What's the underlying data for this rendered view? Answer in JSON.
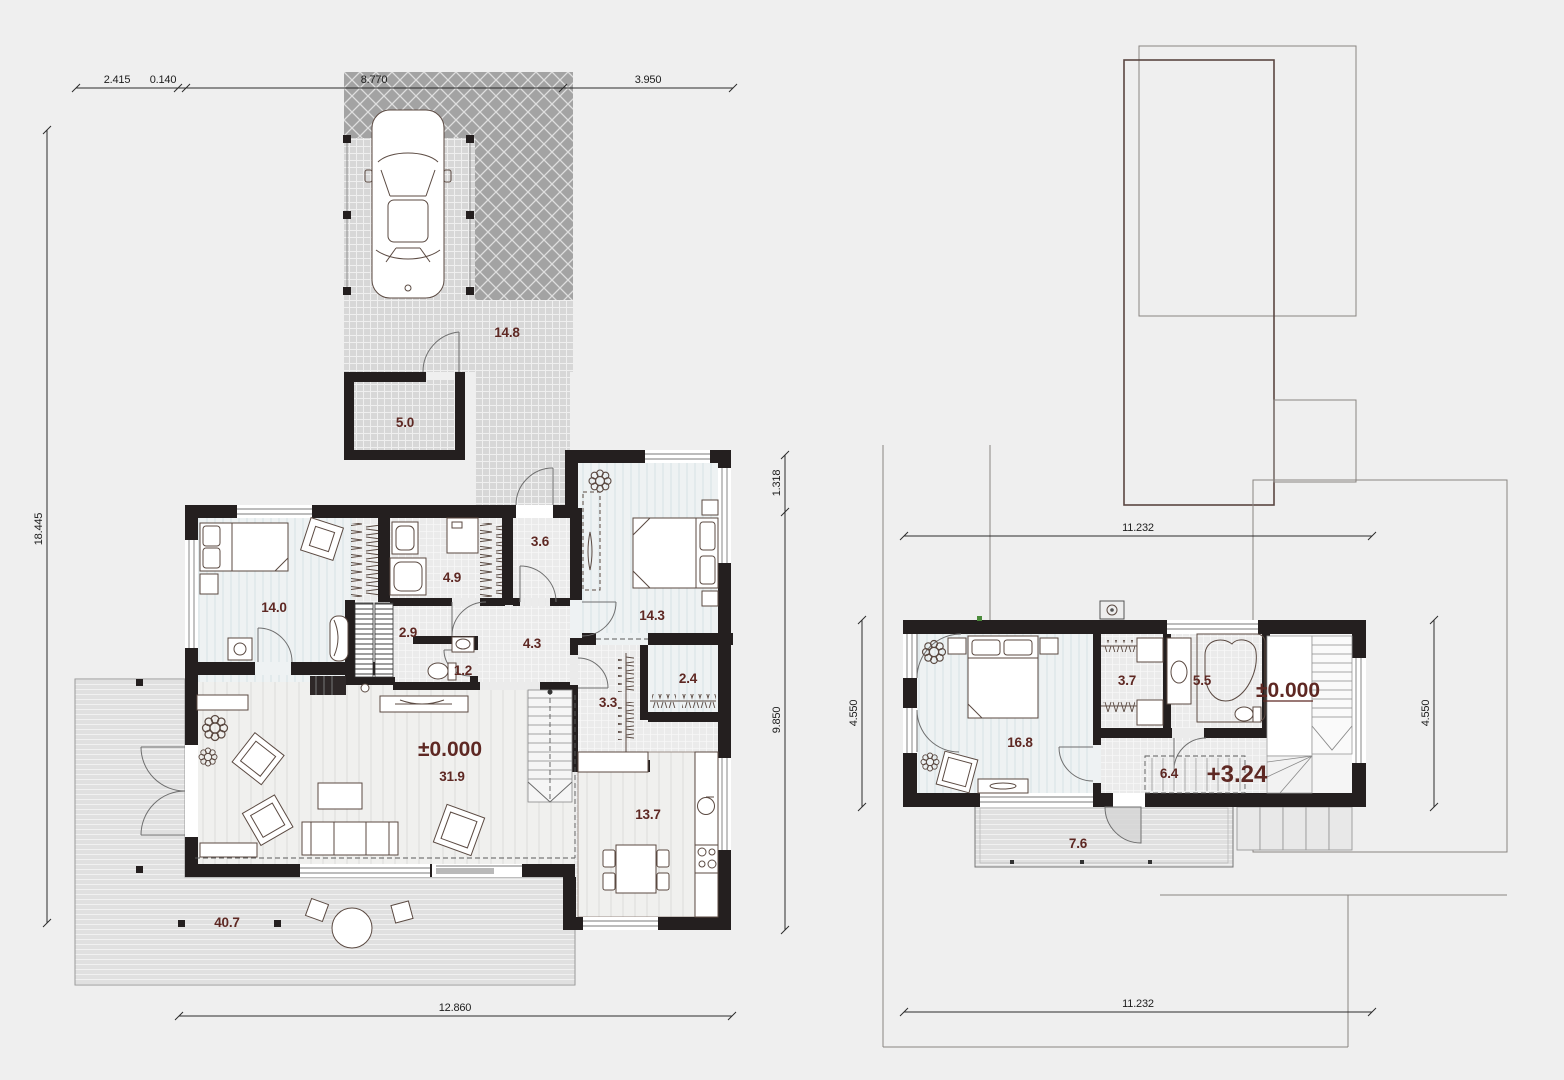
{
  "colors": {
    "background": "#efefef",
    "wall": "#241f1f",
    "label_accent": "#5e2823",
    "paving_dark": "#a3a3a3",
    "paving_light": "#d7d7d7",
    "deck": "#e0e0e0"
  },
  "ground_floor": {
    "dimensions": {
      "top_segments": {
        "a": "2.415",
        "b": "0.140",
        "c": "8.770",
        "d": "3.950"
      },
      "left": "18.445",
      "right_upper": "1.318",
      "right_lower": "9.850",
      "bottom": "12.860"
    },
    "rooms": {
      "bedroom1": "14.0",
      "utility": "4.9",
      "stair_hall": "2.9",
      "wc": "1.2",
      "entry": "3.6",
      "hall": "4.3",
      "bedroom2": "14.3",
      "closet": "2.4",
      "wardrobe": "3.3",
      "living_level": "±0.000",
      "living_area": "31.9",
      "kitchen": "13.7",
      "terrace": "40.7",
      "driveway": "14.8",
      "porch": "5.0"
    }
  },
  "upper_floor": {
    "dimensions": {
      "top": "11.232",
      "bottom": "11.232",
      "left": "4.550",
      "right": "4.550"
    },
    "rooms": {
      "bedroom": "16.8",
      "wardrobe": "3.7",
      "bathroom": "5.5",
      "hall": "6.4",
      "hall_level": "+3.24",
      "stair_level": "±0.000",
      "balcony": "7.6"
    }
  }
}
